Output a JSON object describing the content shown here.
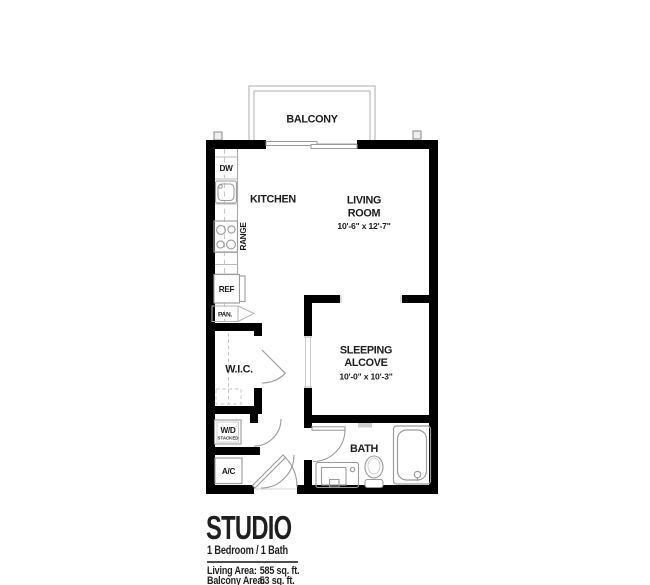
{
  "plan": {
    "balcony": "BALCONY",
    "kitchen": "KITCHEN",
    "living1": "LIVING",
    "living2": "ROOM",
    "living_dims": "10'-6\" x 12'-7\"",
    "sleeping1": "SLEEPING",
    "sleeping2": "ALCOVE",
    "sleeping_dims": "10'-0\" x 10'-3\"",
    "bath": "BATH",
    "wic": "W.I.C.",
    "dw": "DW",
    "range": "RANGE",
    "ref": "REF",
    "pan": "PAN.",
    "wd": "W/D",
    "wd_sub": "STACKED",
    "ac": "A/C"
  },
  "title": {
    "name": "STUDIO",
    "subtitle": "1 Bedroom / 1 Bath",
    "living_label": "Living Area:",
    "living_value": "585 sq. ft.",
    "balcony_label": "Balcony Area:",
    "balcony_value": "53 sq. ft."
  },
  "colors": {
    "wall": "#000000",
    "fixture_line": "#9b9b9b",
    "light_line": "#c4c4c4",
    "text": "#1c1c1c"
  }
}
